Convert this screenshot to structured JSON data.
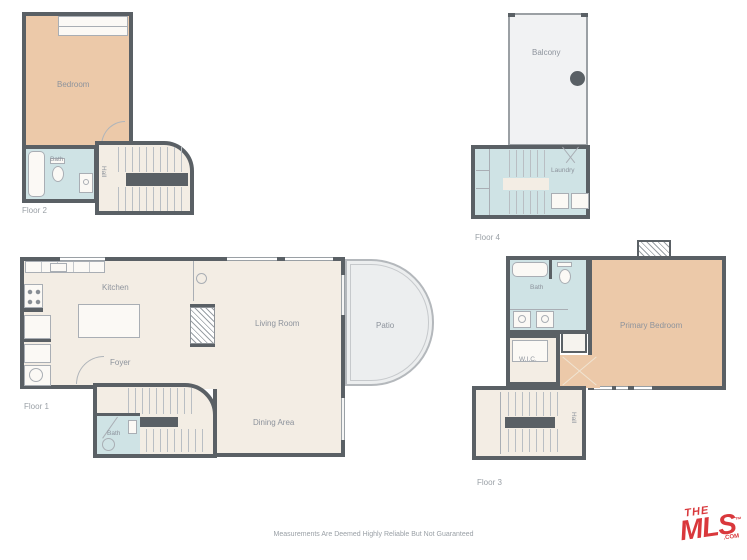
{
  "disclaimer": "Measurements Are Deemed Highly Reliable But Not Guaranteed",
  "logo": {
    "the": "THE",
    "mls": "MLS",
    "tm": "™",
    "com": ".COM"
  },
  "floor1": {
    "label": "Floor 1",
    "kitchen": "Kitchen",
    "foyer": "Foyer",
    "living_room": "Living Room",
    "dining_area": "Dining Area",
    "patio": "Patio",
    "bath": "Bath"
  },
  "floor2": {
    "label": "Floor 2",
    "bedroom": "Bedroom",
    "bath": "Bath",
    "hall": "Hall"
  },
  "floor3": {
    "label": "Floor 3",
    "bath": "Bath",
    "wic": "W.I.C.",
    "primary_bedroom": "Primary Bedroom",
    "hall": "Hall"
  },
  "floor4": {
    "label": "Floor 4",
    "balcony": "Balcony",
    "laundry": "Laundry"
  },
  "colors": {
    "wall": "#5a6065",
    "floor": "#f3ede4",
    "bedroom_fill": "#ecc9a9",
    "bath_fill": "#cfe3e5",
    "outdoor_fill": "#eceeef",
    "label_text": "#8d939c",
    "logo_red": "#d9383c"
  }
}
